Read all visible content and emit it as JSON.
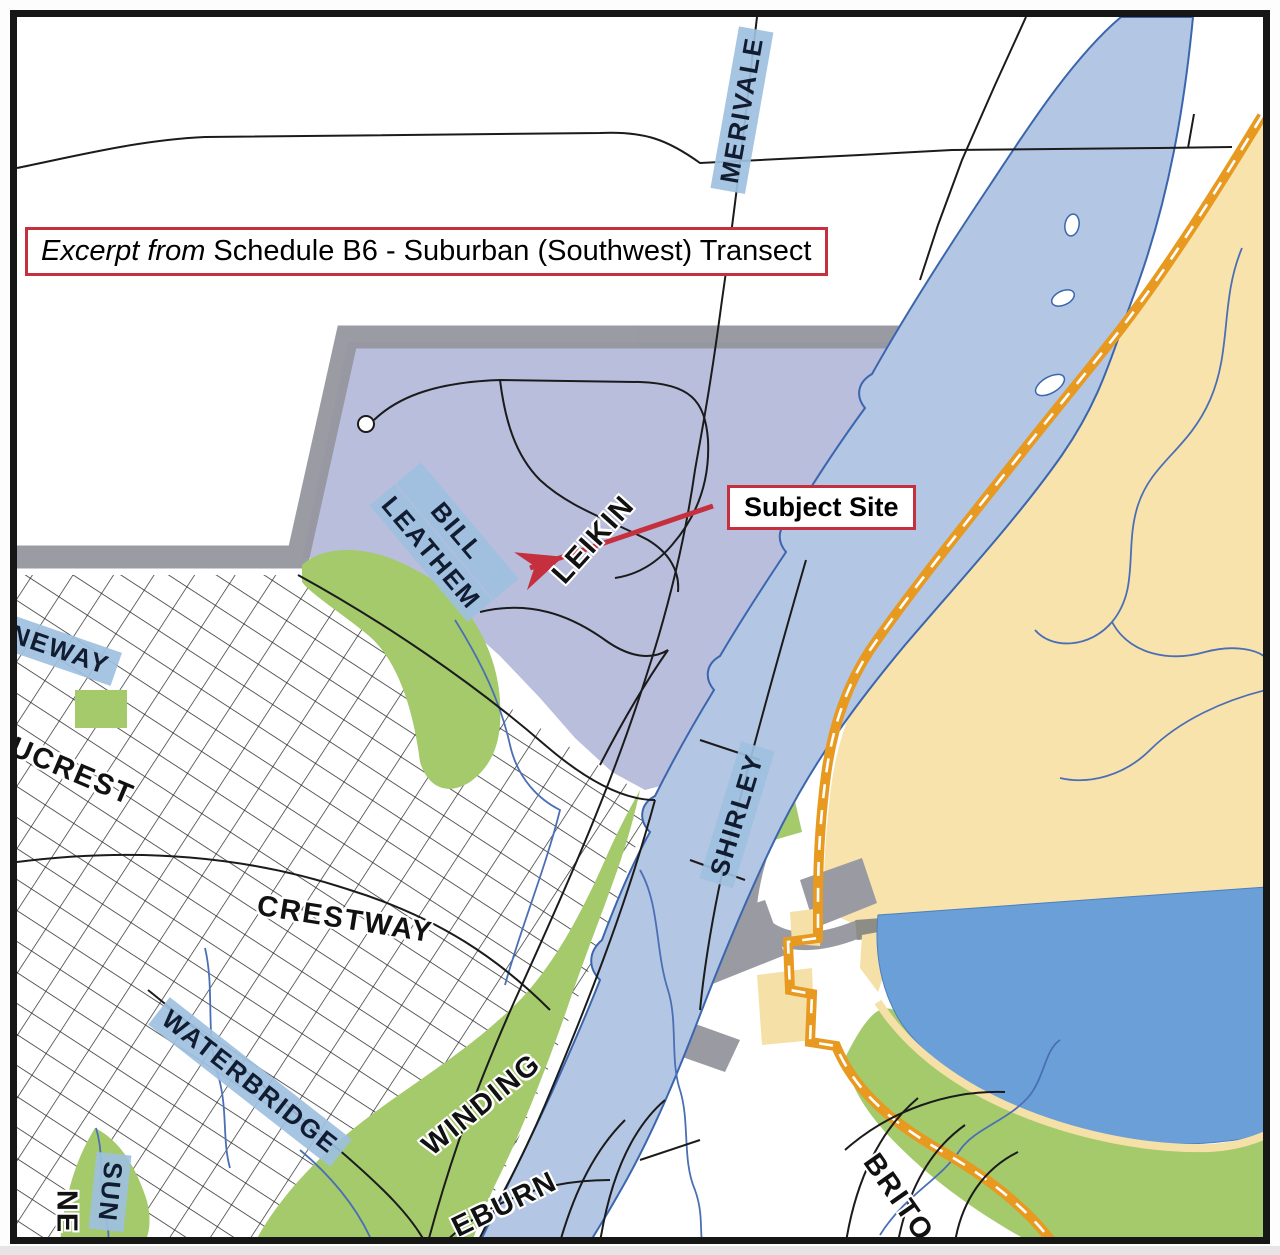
{
  "map": {
    "title_box": {
      "prefix_italic": "Excerpt from",
      "text": " Schedule B6 - Suburban (Southwest) Transect"
    },
    "callout": {
      "label": "Subject Site"
    },
    "street_labels": {
      "merivale": "MERIVALE",
      "bill": "BILL",
      "leathem": "LEATHEM",
      "leikin": "LEIKIN",
      "shirley": "SHIRLEY",
      "neway": "NEWAY",
      "ucrest": "UCREST",
      "crestway": "CRESTWAY",
      "waterbridge": "WATERBRIDGE",
      "winding": "WINDING",
      "sun": "SUN",
      "ne": "NE",
      "eburn": "EBURN",
      "brito": "BRITO"
    },
    "colors": {
      "subject_area_purple": "#b9bedd",
      "river_blue": "#b3c6e3",
      "river_outline": "#3b66ae",
      "lake_blue": "#6b9fd8",
      "rural_yellow": "#f8e3ad",
      "greenspace_green": "#a4ca6c",
      "transitway_orange": "#e8991f",
      "boundary_gray": "#95969e",
      "callout_red": "#c5303e",
      "label_bg_blue": "#9ec0df"
    }
  }
}
